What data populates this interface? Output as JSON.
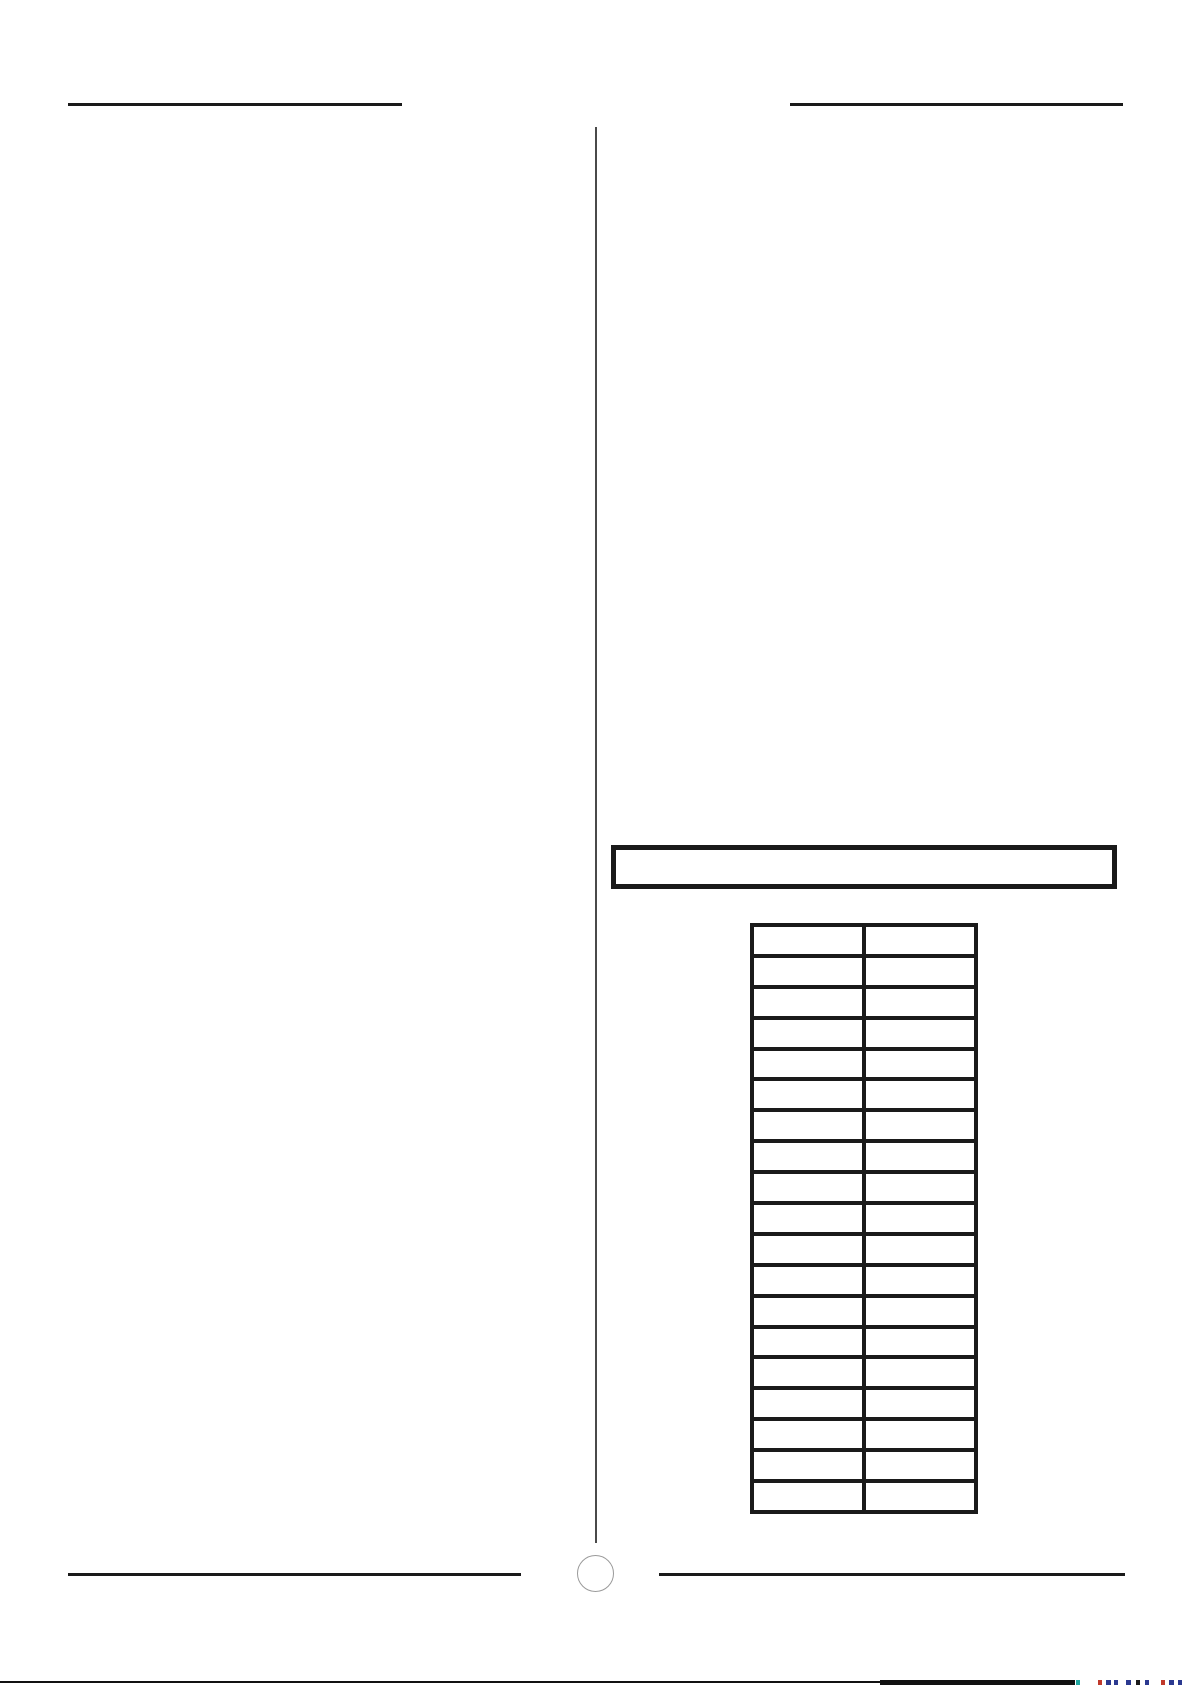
{
  "page": {
    "background_color": "#ffffff",
    "rule_color": "#1a1a1a",
    "divider_color": "#4a4a4a"
  },
  "title_box": {
    "text": ""
  },
  "table": {
    "column_count": 2,
    "row_count": 19,
    "border_color": "#1a1a1a",
    "rows": [
      [
        "",
        ""
      ],
      [
        "",
        ""
      ],
      [
        "",
        ""
      ],
      [
        "",
        ""
      ],
      [
        "",
        ""
      ],
      [
        "",
        ""
      ],
      [
        "",
        ""
      ],
      [
        "",
        ""
      ],
      [
        "",
        ""
      ],
      [
        "",
        ""
      ],
      [
        "",
        ""
      ],
      [
        "",
        ""
      ],
      [
        "",
        ""
      ],
      [
        "",
        ""
      ],
      [
        "",
        ""
      ],
      [
        "",
        ""
      ],
      [
        "",
        ""
      ],
      [
        "",
        ""
      ],
      [
        "",
        ""
      ]
    ]
  },
  "footer": {
    "page_circle_text": "",
    "circle_outline_color": "#9a9a9a"
  },
  "bottom_edge": {
    "bar_color": "#111111",
    "fragments": [
      {
        "x": 1076,
        "w": 4,
        "color": "#1fa7a0"
      },
      {
        "x": 1098,
        "w": 4,
        "color": "#c0392b"
      },
      {
        "x": 1106,
        "w": 5,
        "color": "#2b3990"
      },
      {
        "x": 1114,
        "w": 4,
        "color": "#2b3990"
      },
      {
        "x": 1126,
        "w": 5,
        "color": "#2b3990"
      },
      {
        "x": 1136,
        "w": 4,
        "color": "#1b1b1b"
      },
      {
        "x": 1145,
        "w": 4,
        "color": "#2b3990"
      },
      {
        "x": 1161,
        "w": 4,
        "color": "#c0392b"
      },
      {
        "x": 1169,
        "w": 5,
        "color": "#2b3990"
      },
      {
        "x": 1178,
        "w": 4,
        "color": "#2b3990"
      }
    ]
  }
}
